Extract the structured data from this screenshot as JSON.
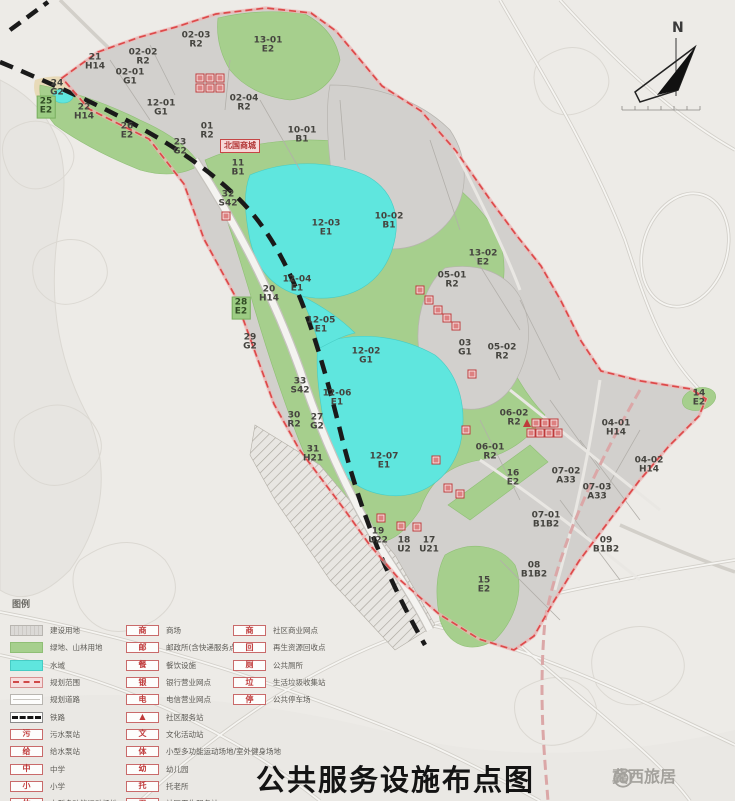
{
  "title": {
    "text": "公共服务设施布点图"
  },
  "watermark": {
    "text": "冀西旅居",
    "icon": "weibo-swirl-icon"
  },
  "north": {
    "label": "N"
  },
  "colors": {
    "green_area": "#a6cf8d",
    "water": "#5fe6de",
    "built_parcel": "#d2d0cd",
    "boundary_red": "#e04848",
    "railway_black": "#1a1a1a",
    "facility_icon_red": "#bf3a3a",
    "background": "#edebe7"
  },
  "legend": {
    "title": "图例",
    "col1": [
      {
        "type": "urban",
        "label": "建设用地"
      },
      {
        "type": "green",
        "label": "绿地、山林用地"
      },
      {
        "type": "water",
        "label": "水域"
      },
      {
        "type": "boundary",
        "label": "规划范围"
      },
      {
        "type": "road",
        "label": "规划道路"
      },
      {
        "type": "rail",
        "label": "铁路"
      },
      {
        "type": "icon",
        "glyph": "污",
        "label": "污水泵站"
      },
      {
        "type": "icon",
        "glyph": "给",
        "label": "给水泵站"
      },
      {
        "type": "icon",
        "glyph": "中",
        "label": "中学"
      },
      {
        "type": "icon",
        "glyph": "小",
        "label": "小学"
      },
      {
        "type": "icon",
        "glyph": "体",
        "label": "中型多功能运动场地"
      }
    ],
    "col2": [
      {
        "glyph": "商",
        "label": "商场"
      },
      {
        "glyph": "邮",
        "label": "邮政所(含快递服务点)"
      },
      {
        "glyph": "餐",
        "label": "餐饮设施"
      },
      {
        "glyph": "银",
        "label": "银行营业网点"
      },
      {
        "glyph": "电",
        "label": "电信营业网点"
      },
      {
        "glyph": "▲",
        "label": "社区服务站",
        "solid": true
      },
      {
        "glyph": "文",
        "label": "文化活动站"
      },
      {
        "glyph": "体",
        "label": "小型多功能运动场地/室外健身场地"
      },
      {
        "glyph": "幼",
        "label": "幼儿园"
      },
      {
        "glyph": "托",
        "label": "托老所"
      },
      {
        "glyph": "卫",
        "label": "社区卫生服务站"
      }
    ],
    "col3": [
      {
        "glyph": "商",
        "label": "社区商业网点"
      },
      {
        "glyph": "回",
        "label": "再生资源回收点"
      },
      {
        "glyph": "厕",
        "label": "公共厕所"
      },
      {
        "glyph": "垃",
        "label": "生活垃圾收集站"
      },
      {
        "glyph": "停",
        "label": "公共停车场"
      }
    ]
  },
  "map": {
    "landmark": {
      "text": "北国商城",
      "x": 240,
      "y": 146
    },
    "parcels": [
      {
        "code": "02-03",
        "zone": "R2",
        "x": 196,
        "y": 41
      },
      {
        "code": "13-01",
        "zone": "E2",
        "x": 268,
        "y": 46
      },
      {
        "code": "21",
        "zone": "H14",
        "x": 95,
        "y": 63
      },
      {
        "code": "02-02",
        "zone": "R2",
        "x": 143,
        "y": 58
      },
      {
        "code": "02-01",
        "zone": "G1",
        "x": 130,
        "y": 78
      },
      {
        "code": "24",
        "zone": "G2",
        "x": 57,
        "y": 89
      },
      {
        "code": "25",
        "zone": "E2",
        "x": 46,
        "y": 107,
        "chip": true
      },
      {
        "code": "22",
        "zone": "H14",
        "x": 84,
        "y": 113
      },
      {
        "code": "12-01",
        "zone": "G1",
        "x": 161,
        "y": 109
      },
      {
        "code": "26",
        "zone": "E2",
        "x": 127,
        "y": 132
      },
      {
        "code": "01",
        "zone": "R2",
        "x": 207,
        "y": 132
      },
      {
        "code": "23",
        "zone": "G2",
        "x": 180,
        "y": 148
      },
      {
        "code": "02-04",
        "zone": "R2",
        "x": 244,
        "y": 104
      },
      {
        "code": "10-01",
        "zone": "B1",
        "x": 302,
        "y": 136
      },
      {
        "code": "11",
        "zone": "B1",
        "x": 238,
        "y": 169
      },
      {
        "code": "32",
        "zone": "S42",
        "x": 228,
        "y": 200
      },
      {
        "code": "10-02",
        "zone": "B1",
        "x": 389,
        "y": 222
      },
      {
        "code": "12-03",
        "zone": "E1",
        "x": 326,
        "y": 229
      },
      {
        "code": "13-02",
        "zone": "E2",
        "x": 483,
        "y": 259
      },
      {
        "code": "05-01",
        "zone": "R2",
        "x": 452,
        "y": 281
      },
      {
        "code": "12-04",
        "zone": "E1",
        "x": 297,
        "y": 285
      },
      {
        "code": "20",
        "zone": "H14",
        "x": 269,
        "y": 295
      },
      {
        "code": "28",
        "zone": "E2",
        "x": 241,
        "y": 308,
        "chip": true
      },
      {
        "code": "12-05",
        "zone": "E1",
        "x": 321,
        "y": 326
      },
      {
        "code": "29",
        "zone": "G2",
        "x": 250,
        "y": 343
      },
      {
        "code": "12-02",
        "zone": "G1",
        "x": 366,
        "y": 357
      },
      {
        "code": "03",
        "zone": "G1",
        "x": 465,
        "y": 349
      },
      {
        "code": "05-02",
        "zone": "R2",
        "x": 502,
        "y": 353
      },
      {
        "code": "33",
        "zone": "S42",
        "x": 300,
        "y": 387
      },
      {
        "code": "12-06",
        "zone": "E1",
        "x": 337,
        "y": 399
      },
      {
        "code": "30",
        "zone": "R2",
        "x": 294,
        "y": 421
      },
      {
        "code": "27",
        "zone": "G2",
        "x": 317,
        "y": 423
      },
      {
        "code": "31",
        "zone": "H21",
        "x": 313,
        "y": 455
      },
      {
        "code": "12-07",
        "zone": "E1",
        "x": 384,
        "y": 462
      },
      {
        "code": "06-02",
        "zone": "R2",
        "x": 514,
        "y": 419
      },
      {
        "code": "04-01",
        "zone": "H14",
        "x": 616,
        "y": 429
      },
      {
        "code": "06-01",
        "zone": "R2",
        "x": 490,
        "y": 453
      },
      {
        "code": "04-02",
        "zone": "H14",
        "x": 649,
        "y": 466
      },
      {
        "code": "16",
        "zone": "E2",
        "x": 513,
        "y": 479
      },
      {
        "code": "07-02",
        "zone": "A33",
        "x": 566,
        "y": 477
      },
      {
        "code": "07-03",
        "zone": "A33",
        "x": 597,
        "y": 493
      },
      {
        "code": "07-01",
        "zone": "B1B2",
        "x": 546,
        "y": 521
      },
      {
        "code": "09",
        "zone": "B1B2",
        "x": 606,
        "y": 546
      },
      {
        "code": "08",
        "zone": "B1B2",
        "x": 534,
        "y": 571
      },
      {
        "code": "15",
        "zone": "E2",
        "x": 484,
        "y": 586
      },
      {
        "code": "19",
        "zone": "U22",
        "x": 378,
        "y": 537
      },
      {
        "code": "18",
        "zone": "U2",
        "x": 404,
        "y": 546
      },
      {
        "code": "17",
        "zone": "U21",
        "x": 429,
        "y": 546
      },
      {
        "code": "14",
        "zone": "E2",
        "x": 699,
        "y": 399
      }
    ],
    "icons": [
      {
        "x": 200,
        "y": 78
      },
      {
        "x": 210,
        "y": 78
      },
      {
        "x": 220,
        "y": 78
      },
      {
        "x": 200,
        "y": 88
      },
      {
        "x": 210,
        "y": 88
      },
      {
        "x": 220,
        "y": 88
      },
      {
        "x": 226,
        "y": 216
      },
      {
        "x": 420,
        "y": 290
      },
      {
        "x": 429,
        "y": 300
      },
      {
        "x": 438,
        "y": 310
      },
      {
        "x": 447,
        "y": 318
      },
      {
        "x": 456,
        "y": 326
      },
      {
        "x": 472,
        "y": 374
      },
      {
        "x": 527,
        "y": 423,
        "shape": "triangle"
      },
      {
        "x": 536,
        "y": 423
      },
      {
        "x": 545,
        "y": 423
      },
      {
        "x": 554,
        "y": 423
      },
      {
        "x": 531,
        "y": 433
      },
      {
        "x": 540,
        "y": 433
      },
      {
        "x": 549,
        "y": 433
      },
      {
        "x": 558,
        "y": 433
      },
      {
        "x": 466,
        "y": 430
      },
      {
        "x": 436,
        "y": 460
      },
      {
        "x": 448,
        "y": 488
      },
      {
        "x": 460,
        "y": 494
      },
      {
        "x": 381,
        "y": 518
      },
      {
        "x": 401,
        "y": 526
      },
      {
        "x": 417,
        "y": 527
      }
    ]
  }
}
